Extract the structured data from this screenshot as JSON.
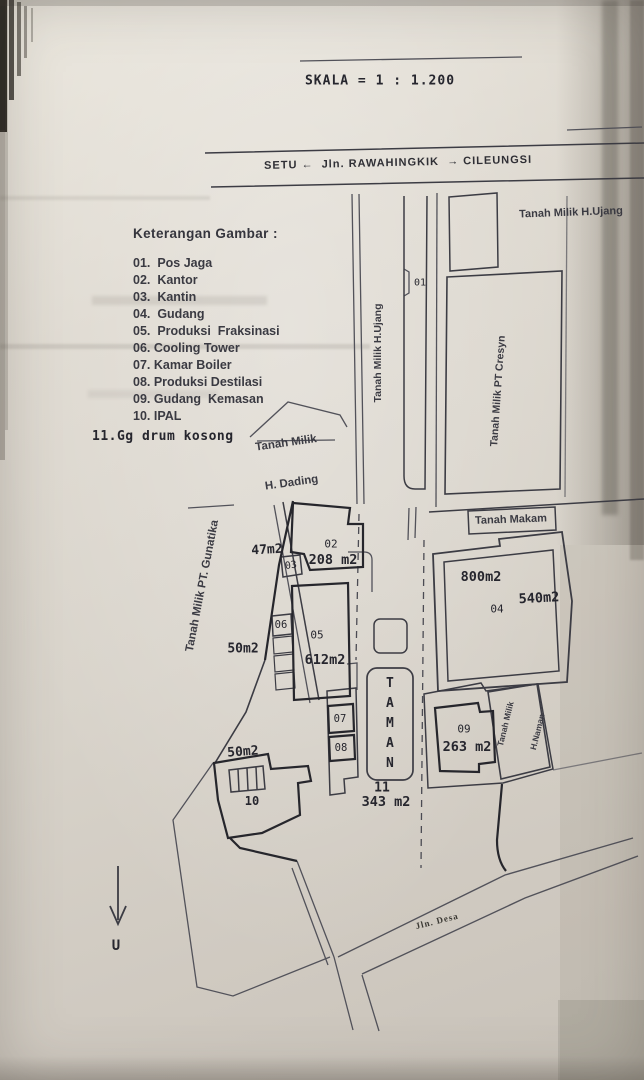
{
  "scale_text": "SKALA = 1 : 1.200",
  "road_top": {
    "left_town": "SETU",
    "arrow_left": "←",
    "name": "Jln. RAWAHINGKIK",
    "arrow_right": "→",
    "right_town": "CILEUNGSI"
  },
  "legend": {
    "title": "Keterangan  Gambar :",
    "items": [
      "01.  Pos Jaga",
      "02.  Kantor",
      "03.  Kantin",
      "04.  Gudang",
      "05.  Produksi  Fraksinasi",
      "06. Cooling Tower",
      "07. Kamar Boiler",
      "08. Produksi Destilasi",
      "09. Gudang  Kemasan",
      "10. IPAL"
    ],
    "item_11": "11.Gg drum kosong"
  },
  "neighbors": {
    "ujang_right": "Tanah Milik H.Ujang",
    "ujang_strip": "Tanah Milik H.Ujang",
    "cresyn": "Tanah Milik PT Cresyn",
    "dading_line1": "Tanah Milik",
    "dading_line2": "H. Dading",
    "gunatika": "Tanah Milik PT. Gunatika",
    "makam": "Tanah Makam",
    "naman_line1": "Tanah Milik",
    "naman_line2": "H.Naman"
  },
  "parcels": {
    "p01_num": "01",
    "p02_num": "02",
    "p02_area": "208 m2",
    "p02_west_area": "47m2",
    "p03_num": "03",
    "p04_num": "04",
    "p04_area": "800m2",
    "p04_east_area": "540m2",
    "p05_num": "05",
    "p05_area": "612m2",
    "p05_west_area": "50m2",
    "p06_num": "06",
    "p07_num": "07",
    "p08_num": "08",
    "p09_num": "09",
    "p09_area": "263 m2",
    "p10_num": "10",
    "p10_west_area": "50m2",
    "p11_num": "11",
    "p11_area": "343 m2",
    "taman": "TAMAN"
  },
  "road_bottom": "Jln. Desa",
  "north": "U"
}
